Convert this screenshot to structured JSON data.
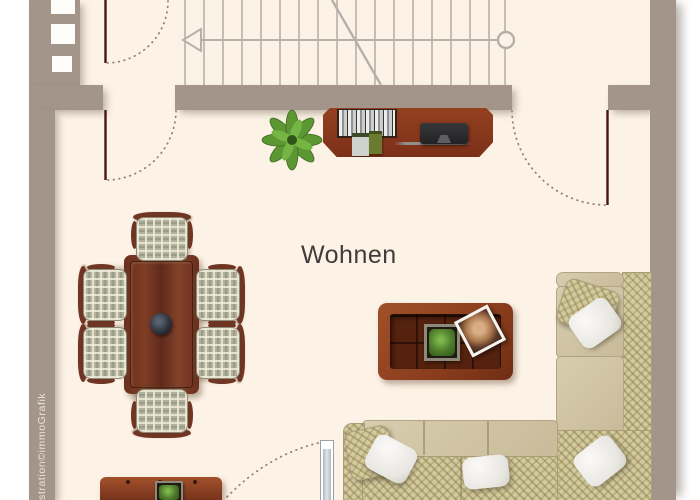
{
  "floorplan": {
    "room_label": "Wohnen",
    "watermark": "stration©immoGrafik",
    "colors": {
      "floor": "#fcf2e5",
      "outside": "#ffffff",
      "wall": "#a3958a",
      "door_line": "#471610",
      "swing_arc_dots": "#94846f",
      "stair_lines": "#b5b1aa",
      "wood_dark": "#7f3d26",
      "sofa_beige": "#d0c4a5",
      "sofa_pattern": "#d4caa0",
      "plant_green": "#5d9733",
      "label_text": "#3f3d3b",
      "watermark_text": "#e9e3d9"
    },
    "furniture": [
      "staircase",
      "tv-sideboard",
      "potted-plant",
      "dining-table",
      "dining-chairs-x6",
      "coffee-table",
      "corner-sofa",
      "lowboard",
      "terrace-door",
      "swing-doors-x3"
    ]
  }
}
